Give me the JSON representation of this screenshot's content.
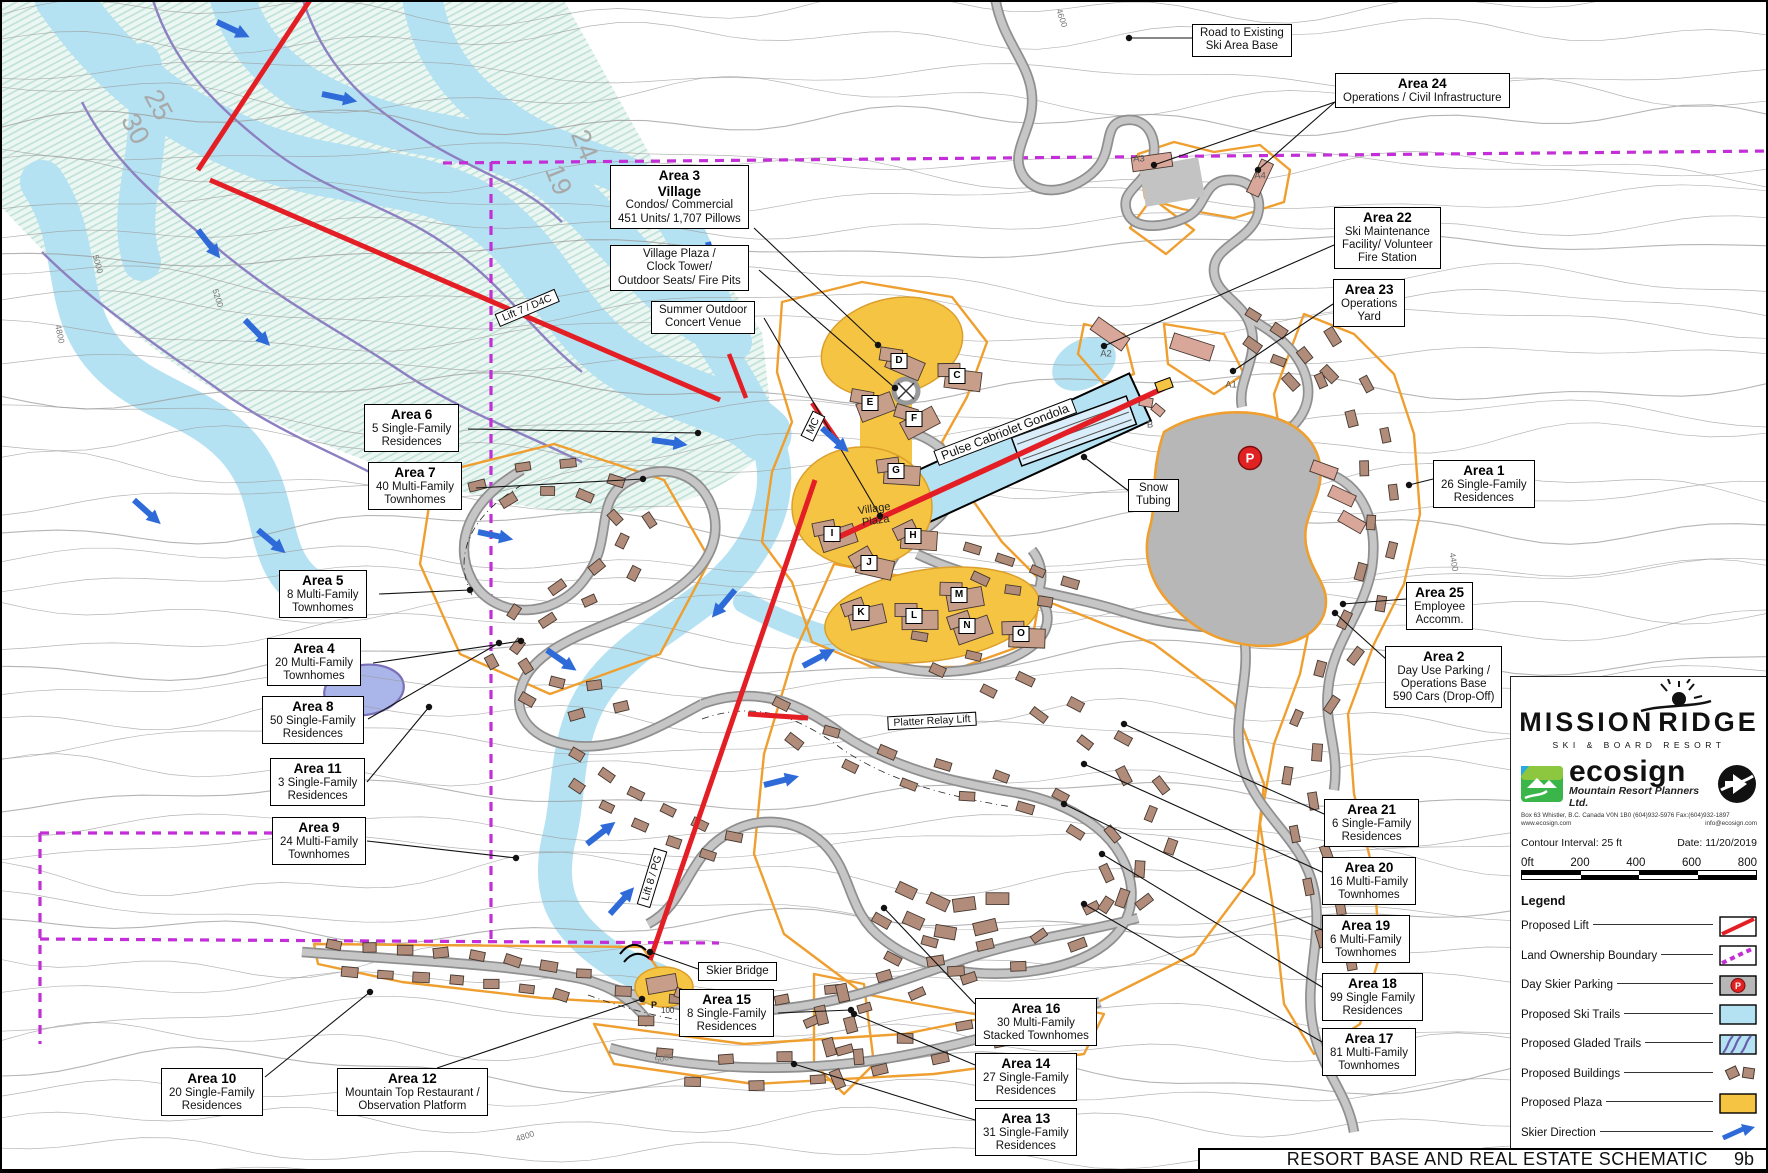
{
  "title_bar": {
    "text": "RESORT BASE AND REAL ESTATE SCHEMATIC",
    "sheet": "9b"
  },
  "logo": {
    "resort_left": "MISSION",
    "resort_right": "RIDGE",
    "resort_sub": "SKI  &  BOARD  RESORT",
    "planner": "ecosign",
    "planner_sub": "Mountain  Resort Planners Ltd.",
    "addr1": "Box 63 Whistler, B.C. Canada V0N 1B0 (604)932-5976  Fax:(604)932-1897",
    "addr2": "www.ecosign.com",
    "addr3": "info@ecosign.com"
  },
  "map_info": {
    "contour_interval": "Contour Interval: 25 ft",
    "date": "Date:  11/20/2019",
    "scale_ticks": [
      "0ft",
      "200",
      "400",
      "600",
      "800"
    ]
  },
  "legend": {
    "heading": "Legend",
    "items": [
      {
        "label": "Proposed Lift",
        "swatch": "lift"
      },
      {
        "label": "Land Ownership Boundary",
        "swatch": "boundary"
      },
      {
        "label": "Day Skier Parking",
        "swatch": "parking"
      },
      {
        "label": "Proposed Ski Trails",
        "swatch": "ski-trails"
      },
      {
        "label": "Proposed Gladed Trails",
        "swatch": "gladed-trails"
      },
      {
        "label": "Proposed Buildings",
        "swatch": "buildings"
      },
      {
        "label": "Proposed Plaza",
        "swatch": "plaza"
      },
      {
        "label": "Skier Direction",
        "swatch": "skier-direction"
      }
    ]
  },
  "colors": {
    "lift_red": "#e31e24",
    "boundary_magenta": "#c32fd6",
    "trail_blue": "#b5e2f2",
    "plaza_yellow": "#f6c443",
    "parcel_orange": "#ef9f2f",
    "parking_gray": "#b7b7b7",
    "building_brown": "#b18c7a",
    "arrow_blue": "#2e6bd8",
    "creek_purple": "#8d80c2"
  },
  "callouts": [
    {
      "id": "road-to-base",
      "x": 1190,
      "y": 22,
      "bold": 0,
      "lines": [
        "Road to Existing",
        "Ski Area Base"
      ]
    },
    {
      "id": "area-24",
      "x": 1333,
      "y": 71,
      "bold": 1,
      "lines": [
        "Area 24",
        "Operations / Civil Infrastructure"
      ]
    },
    {
      "id": "area-22",
      "x": 1332,
      "y": 205,
      "bold": 1,
      "lines": [
        "Area 22",
        "Ski Maintenance",
        "Facility/ Volunteer",
        "Fire Station"
      ]
    },
    {
      "id": "area-23",
      "x": 1331,
      "y": 277,
      "bold": 1,
      "lines": [
        "Area 23",
        "Operations",
        "Yard"
      ]
    },
    {
      "id": "area-3",
      "x": 608,
      "y": 163,
      "bold": 2,
      "lines": [
        "Area 3",
        "Village",
        "Condos/ Commercial",
        "451 Units/ 1,707 Pillows"
      ]
    },
    {
      "id": "village-plaza-note",
      "x": 608,
      "y": 243,
      "bold": 0,
      "lines": [
        "Village Plaza /",
        "Clock Tower/",
        "Outdoor Seats/ Fire Pits"
      ]
    },
    {
      "id": "summer-venue",
      "x": 649,
      "y": 299,
      "bold": 0,
      "lines": [
        "Summer Outdoor",
        "Concert Venue"
      ]
    },
    {
      "id": "area-6",
      "x": 362,
      "y": 402,
      "bold": 1,
      "lines": [
        "Area 6",
        "5 Single-Family",
        "Residences"
      ]
    },
    {
      "id": "area-7",
      "x": 366,
      "y": 460,
      "bold": 1,
      "lines": [
        "Area 7",
        "40 Multi-Family",
        "Townhomes"
      ]
    },
    {
      "id": "area-5",
      "x": 277,
      "y": 568,
      "bold": 1,
      "lines": [
        "Area 5",
        "8 Multi-Family",
        "Townhomes"
      ]
    },
    {
      "id": "area-4",
      "x": 265,
      "y": 636,
      "bold": 1,
      "lines": [
        "Area 4",
        "20 Multi-Family",
        "Townhomes"
      ]
    },
    {
      "id": "area-8",
      "x": 260,
      "y": 694,
      "bold": 1,
      "lines": [
        "Area 8",
        "50 Single-Family",
        "Residences"
      ]
    },
    {
      "id": "area-11",
      "x": 268,
      "y": 756,
      "bold": 1,
      "lines": [
        "Area 11",
        "3 Single-Family",
        "Residences"
      ]
    },
    {
      "id": "area-9",
      "x": 270,
      "y": 815,
      "bold": 1,
      "lines": [
        "Area 9",
        "24 Multi-Family",
        "Townhomes"
      ]
    },
    {
      "id": "area-10",
      "x": 159,
      "y": 1066,
      "bold": 1,
      "lines": [
        "Area 10",
        "20 Single-Family",
        "Residences"
      ]
    },
    {
      "id": "area-12",
      "x": 335,
      "y": 1066,
      "bold": 1,
      "lines": [
        "Area 12",
        "Mountain Top Restaurant /",
        "Observation Platform"
      ]
    },
    {
      "id": "skier-bridge",
      "x": 696,
      "y": 960,
      "bold": 0,
      "lines": [
        "Skier Bridge"
      ]
    },
    {
      "id": "area-15",
      "x": 677,
      "y": 987,
      "bold": 1,
      "lines": [
        "Area 15",
        "8 Single-Family",
        "Residences"
      ]
    },
    {
      "id": "area-16",
      "x": 973,
      "y": 996,
      "bold": 1,
      "lines": [
        "Area 16",
        "30 Multi-Family",
        "Stacked Townhomes"
      ]
    },
    {
      "id": "area-14",
      "x": 973,
      "y": 1051,
      "bold": 1,
      "lines": [
        "Area 14",
        "27 Single-Family",
        "Residences"
      ]
    },
    {
      "id": "area-13",
      "x": 973,
      "y": 1106,
      "bold": 1,
      "lines": [
        "Area 13",
        "31 Single-Family",
        "Residences"
      ]
    },
    {
      "id": "area-21",
      "x": 1322,
      "y": 797,
      "bold": 1,
      "lines": [
        "Area 21",
        "6 Single-Family",
        "Residences"
      ]
    },
    {
      "id": "area-20",
      "x": 1320,
      "y": 855,
      "bold": 1,
      "lines": [
        "Area 20",
        "16 Multi-Family",
        "Townhomes"
      ]
    },
    {
      "id": "area-19",
      "x": 1320,
      "y": 913,
      "bold": 1,
      "lines": [
        "Area 19",
        "6 Multi-Family",
        "Townhomes"
      ]
    },
    {
      "id": "area-18",
      "x": 1320,
      "y": 971,
      "bold": 1,
      "lines": [
        "Area 18",
        "99 Single Family",
        "Residences"
      ]
    },
    {
      "id": "area-17",
      "x": 1320,
      "y": 1026,
      "bold": 1,
      "lines": [
        "Area 17",
        "81 Multi-Family",
        "Townhomes"
      ]
    },
    {
      "id": "area-1",
      "x": 1431,
      "y": 458,
      "bold": 1,
      "lines": [
        "Area 1",
        "26 Single-Family",
        "Residences"
      ]
    },
    {
      "id": "area-25",
      "x": 1404,
      "y": 580,
      "bold": 1,
      "lines": [
        "Area 25",
        "Employee",
        "Accomm."
      ]
    },
    {
      "id": "area-2",
      "x": 1383,
      "y": 644,
      "bold": 1,
      "lines": [
        "Area 2",
        "Day Use Parking /",
        "Operations Base",
        "590 Cars (Drop-Off)"
      ]
    },
    {
      "id": "snow-tubing",
      "x": 1126,
      "y": 477,
      "bold": 0,
      "lines": [
        "Snow",
        "Tubing"
      ]
    }
  ],
  "lift_labels": [
    {
      "id": "lift-7-d4c",
      "text": "Lift 7 / D4C",
      "x": 525,
      "y": 306,
      "rot": -23
    },
    {
      "id": "mc",
      "text": "MC",
      "x": 811,
      "y": 424,
      "rot": -64
    },
    {
      "id": "pulse-gondola",
      "text": "Pulse Cabriolet Gondola",
      "x": 1003,
      "y": 430,
      "rot": -21
    },
    {
      "id": "platter-relay",
      "text": "Platter Relay Lift",
      "x": 930,
      "y": 719,
      "rot": -3
    },
    {
      "id": "lift-8-pg",
      "text": "Lift 8 / PG",
      "x": 650,
      "y": 876,
      "rot": -73
    }
  ],
  "plaza_label": {
    "line1": "Village",
    "line2": "Plaza",
    "x": 873,
    "y": 513
  },
  "village_letters": [
    {
      "t": "D",
      "x": 897,
      "y": 359
    },
    {
      "t": "C",
      "x": 955,
      "y": 374
    },
    {
      "t": "E",
      "x": 868,
      "y": 401
    },
    {
      "t": "F",
      "x": 912,
      "y": 417
    },
    {
      "t": "G",
      "x": 894,
      "y": 469
    },
    {
      "t": "I",
      "x": 830,
      "y": 532
    },
    {
      "t": "H",
      "x": 911,
      "y": 534
    },
    {
      "t": "J",
      "x": 867,
      "y": 561
    },
    {
      "t": "K",
      "x": 859,
      "y": 611
    },
    {
      "t": "L",
      "x": 912,
      "y": 614
    },
    {
      "t": "M",
      "x": 957,
      "y": 593
    },
    {
      "t": "N",
      "x": 965,
      "y": 624
    },
    {
      "t": "O",
      "x": 1019,
      "y": 632
    }
  ],
  "parcel_letters": [
    {
      "t": "A3",
      "x": 1137,
      "y": 157
    },
    {
      "t": "A4",
      "x": 1258,
      "y": 174
    },
    {
      "t": "A2",
      "x": 1104,
      "y": 352
    },
    {
      "t": "A1",
      "x": 1229,
      "y": 383
    },
    {
      "t": "B",
      "x": 1148,
      "y": 423
    }
  ],
  "parking": {
    "letter": "P"
  },
  "mtn_parking": {
    "p": "P",
    "num": "100"
  },
  "trail_numbers": [
    {
      "t": "30",
      "x": 133,
      "y": 127,
      "rot": 62
    },
    {
      "t": "25",
      "x": 156,
      "y": 103,
      "rot": 62
    },
    {
      "t": "19",
      "x": 556,
      "y": 178,
      "rot": 68
    },
    {
      "t": "24",
      "x": 582,
      "y": 143,
      "rot": 68
    }
  ],
  "elevations": [
    {
      "t": "5000",
      "x": 662,
      "y": 1056,
      "rot": -12
    },
    {
      "t": "4800",
      "x": 523,
      "y": 1134,
      "rot": -18
    },
    {
      "t": "5200",
      "x": 216,
      "y": 296,
      "rot": 72
    },
    {
      "t": "5000",
      "x": 96,
      "y": 262,
      "rot": 75
    },
    {
      "t": "4800",
      "x": 58,
      "y": 332,
      "rot": 78
    },
    {
      "t": "4600",
      "x": 1060,
      "y": 16,
      "rot": 72
    },
    {
      "t": "4400",
      "x": 1452,
      "y": 560,
      "rot": 80
    }
  ]
}
